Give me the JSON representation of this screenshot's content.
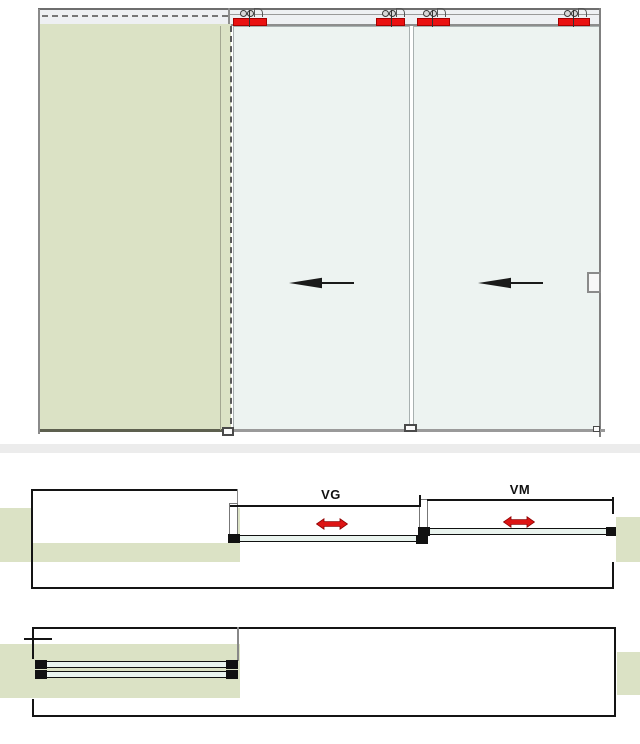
{
  "diagram": {
    "title": "sliding-glass-door-system-technical-drawing",
    "views": {
      "elevation": {
        "description": "front elevation: fixed wall section left, two sliding glass panels moving left",
        "panel_count": 3,
        "carriage_count": 4,
        "slide_direction": "left"
      },
      "plan_open": {
        "description": "top view, panels partially open with travel dimensions",
        "labels": {
          "vg": "VG",
          "vm": "VM"
        }
      },
      "plan_closed": {
        "description": "top view, both panels parked/stacked over wall pocket"
      }
    },
    "colors": {
      "carriage_red": "#ea1111",
      "arrow_red": "#dd1414",
      "wall_green": "#dbe2c5",
      "glass_fill": "#edf3f1",
      "glass_plan_fill": "#e9f3ee",
      "track_fill": "#eef0f3",
      "divider_band": "#ececec",
      "line_dark": "#141414",
      "line_gray": "#888888"
    }
  }
}
